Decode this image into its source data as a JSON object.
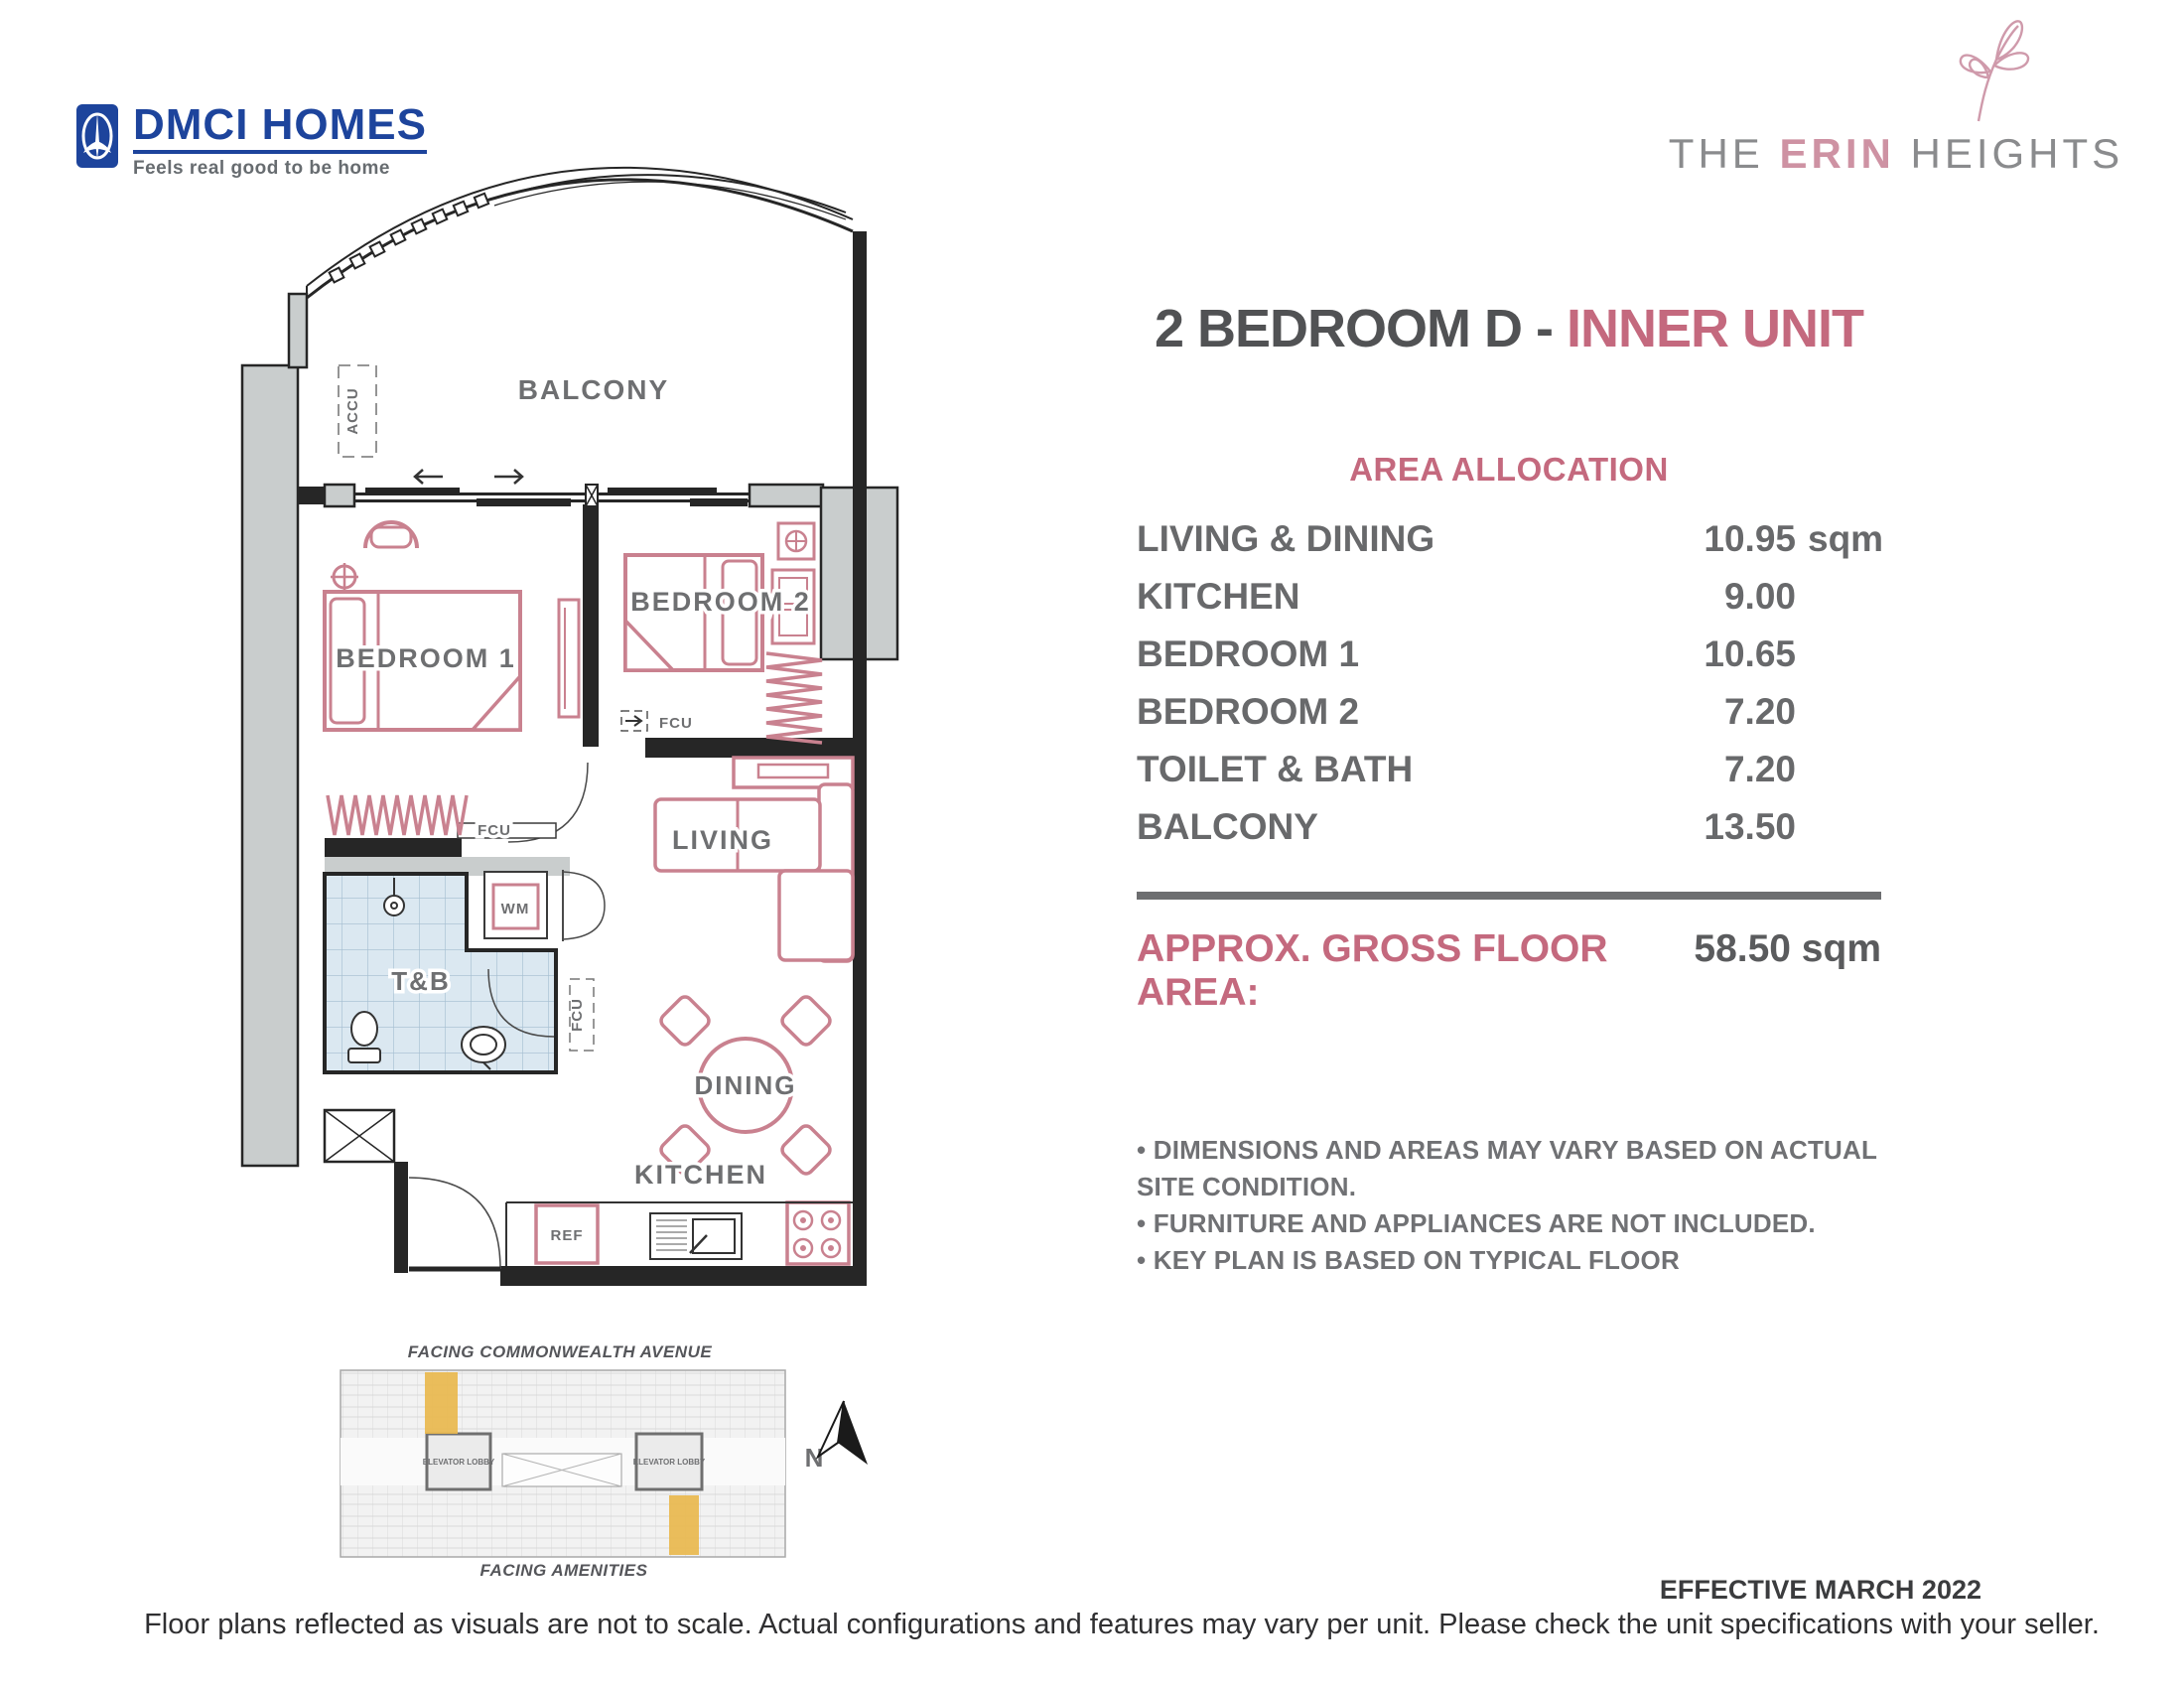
{
  "brand": {
    "dmci_name": "DMCI HOMES",
    "dmci_tagline": "Feels real good to be home",
    "erin_the": "THE",
    "erin_erin": "ERIN",
    "erin_heights": "HEIGHTS"
  },
  "title": {
    "main": "2 BEDROOM D - ",
    "accent": "INNER UNIT"
  },
  "area": {
    "heading": "AREA ALLOCATION",
    "rows": [
      {
        "label": "LIVING & DINING",
        "value": "10.95",
        "unit": "sqm"
      },
      {
        "label": "KITCHEN",
        "value": "9.00",
        "unit": ""
      },
      {
        "label": "BEDROOM 1",
        "value": "10.65",
        "unit": ""
      },
      {
        "label": "BEDROOM 2",
        "value": "7.20",
        "unit": ""
      },
      {
        "label": "TOILET & BATH",
        "value": "7.20",
        "unit": ""
      },
      {
        "label": "BALCONY",
        "value": "13.50",
        "unit": ""
      }
    ],
    "gross_label": "APPROX. GROSS FLOOR AREA:",
    "gross_value": "58.50 sqm"
  },
  "notes": [
    "• DIMENSIONS AND AREAS MAY VARY BASED ON ACTUAL SITE CONDITION.",
    "• FURNITURE AND APPLIANCES ARE NOT INCLUDED.",
    "• KEY PLAN IS BASED ON TYPICAL FLOOR"
  ],
  "plan": {
    "balcony": "BALCONY",
    "bedroom1": "BEDROOM 1",
    "bedroom2": "BEDROOM 2",
    "living": "LIVING",
    "tb": "T&B",
    "dining": "DINING",
    "kitchen": "KITCHEN",
    "accu": "ACCU",
    "fcu": "FCU",
    "wm": "WM",
    "ref": "REF"
  },
  "keyplan": {
    "top_caption": "FACING COMMONWEALTH AVENUE",
    "bottom_caption": "FACING AMENITIES",
    "lobby": "ELEVATOR LOBBY",
    "north": "N",
    "highlight_color": "#e9b84e"
  },
  "footer": {
    "effective": "EFFECTIVE MARCH 2022",
    "disclaimer": "Floor plans reflected as visuals are not to scale. Actual configurations and features may vary per unit. Please check the unit specifications with your seller."
  },
  "colors": {
    "accent_pink": "#c4697e",
    "furniture_pink": "#c9818f",
    "label_gray": "#6e6f71",
    "dmci_blue": "#1d449c"
  }
}
